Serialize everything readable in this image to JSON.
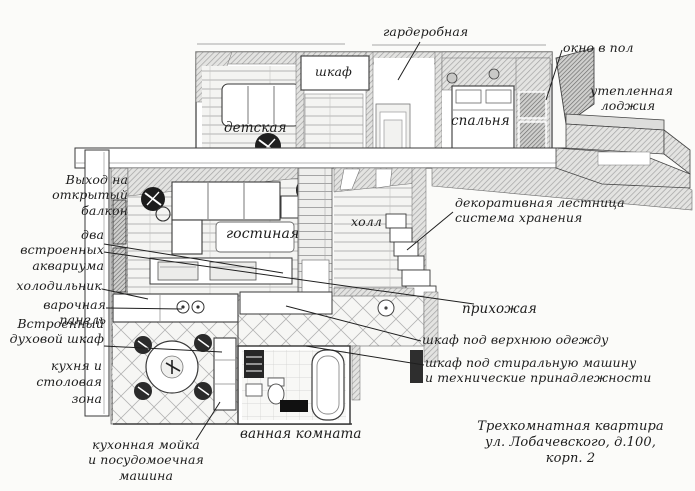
{
  "title": "Трехкомнатная квартира — план",
  "room_labels": {
    "closet": "шкаф",
    "kids": "детская",
    "bedroom": "спальня",
    "living": "гостиная",
    "hall": "холл"
  },
  "callouts": {
    "balcony_exit": "Выход на\nоткрытый балкон",
    "wardrobe": "гардеробная",
    "window_floor": "окно в пол",
    "loggia": "утепленная\nлоджия",
    "aquariums": "два встроенных\nаквариума",
    "fridge": "холодильник",
    "cooktop": "варочная панель",
    "oven": "Встроенный\nдуховой шкаф",
    "kitchen": "кухня и\nстоловая\nзона",
    "stairs": "декоративная лестница\nсистема хранения",
    "entry": "прихожая",
    "coat_closet": "шкаф под верхнюю одежду",
    "washer_closet": "шкаф под стиральную машину\nи технические принадлежности",
    "bathroom": "ванная комната",
    "kitchen_sink": "кухонная мойка\nи посудомоечная машина"
  },
  "caption": "Трехкомнатная квартира\nул. Лобачевского, д.100, корп. 2",
  "colors": {
    "ink": "#1d1d1d",
    "paper": "#fbfbf9",
    "line": "#3a3a3a",
    "hatch": "#a3a3a3"
  }
}
